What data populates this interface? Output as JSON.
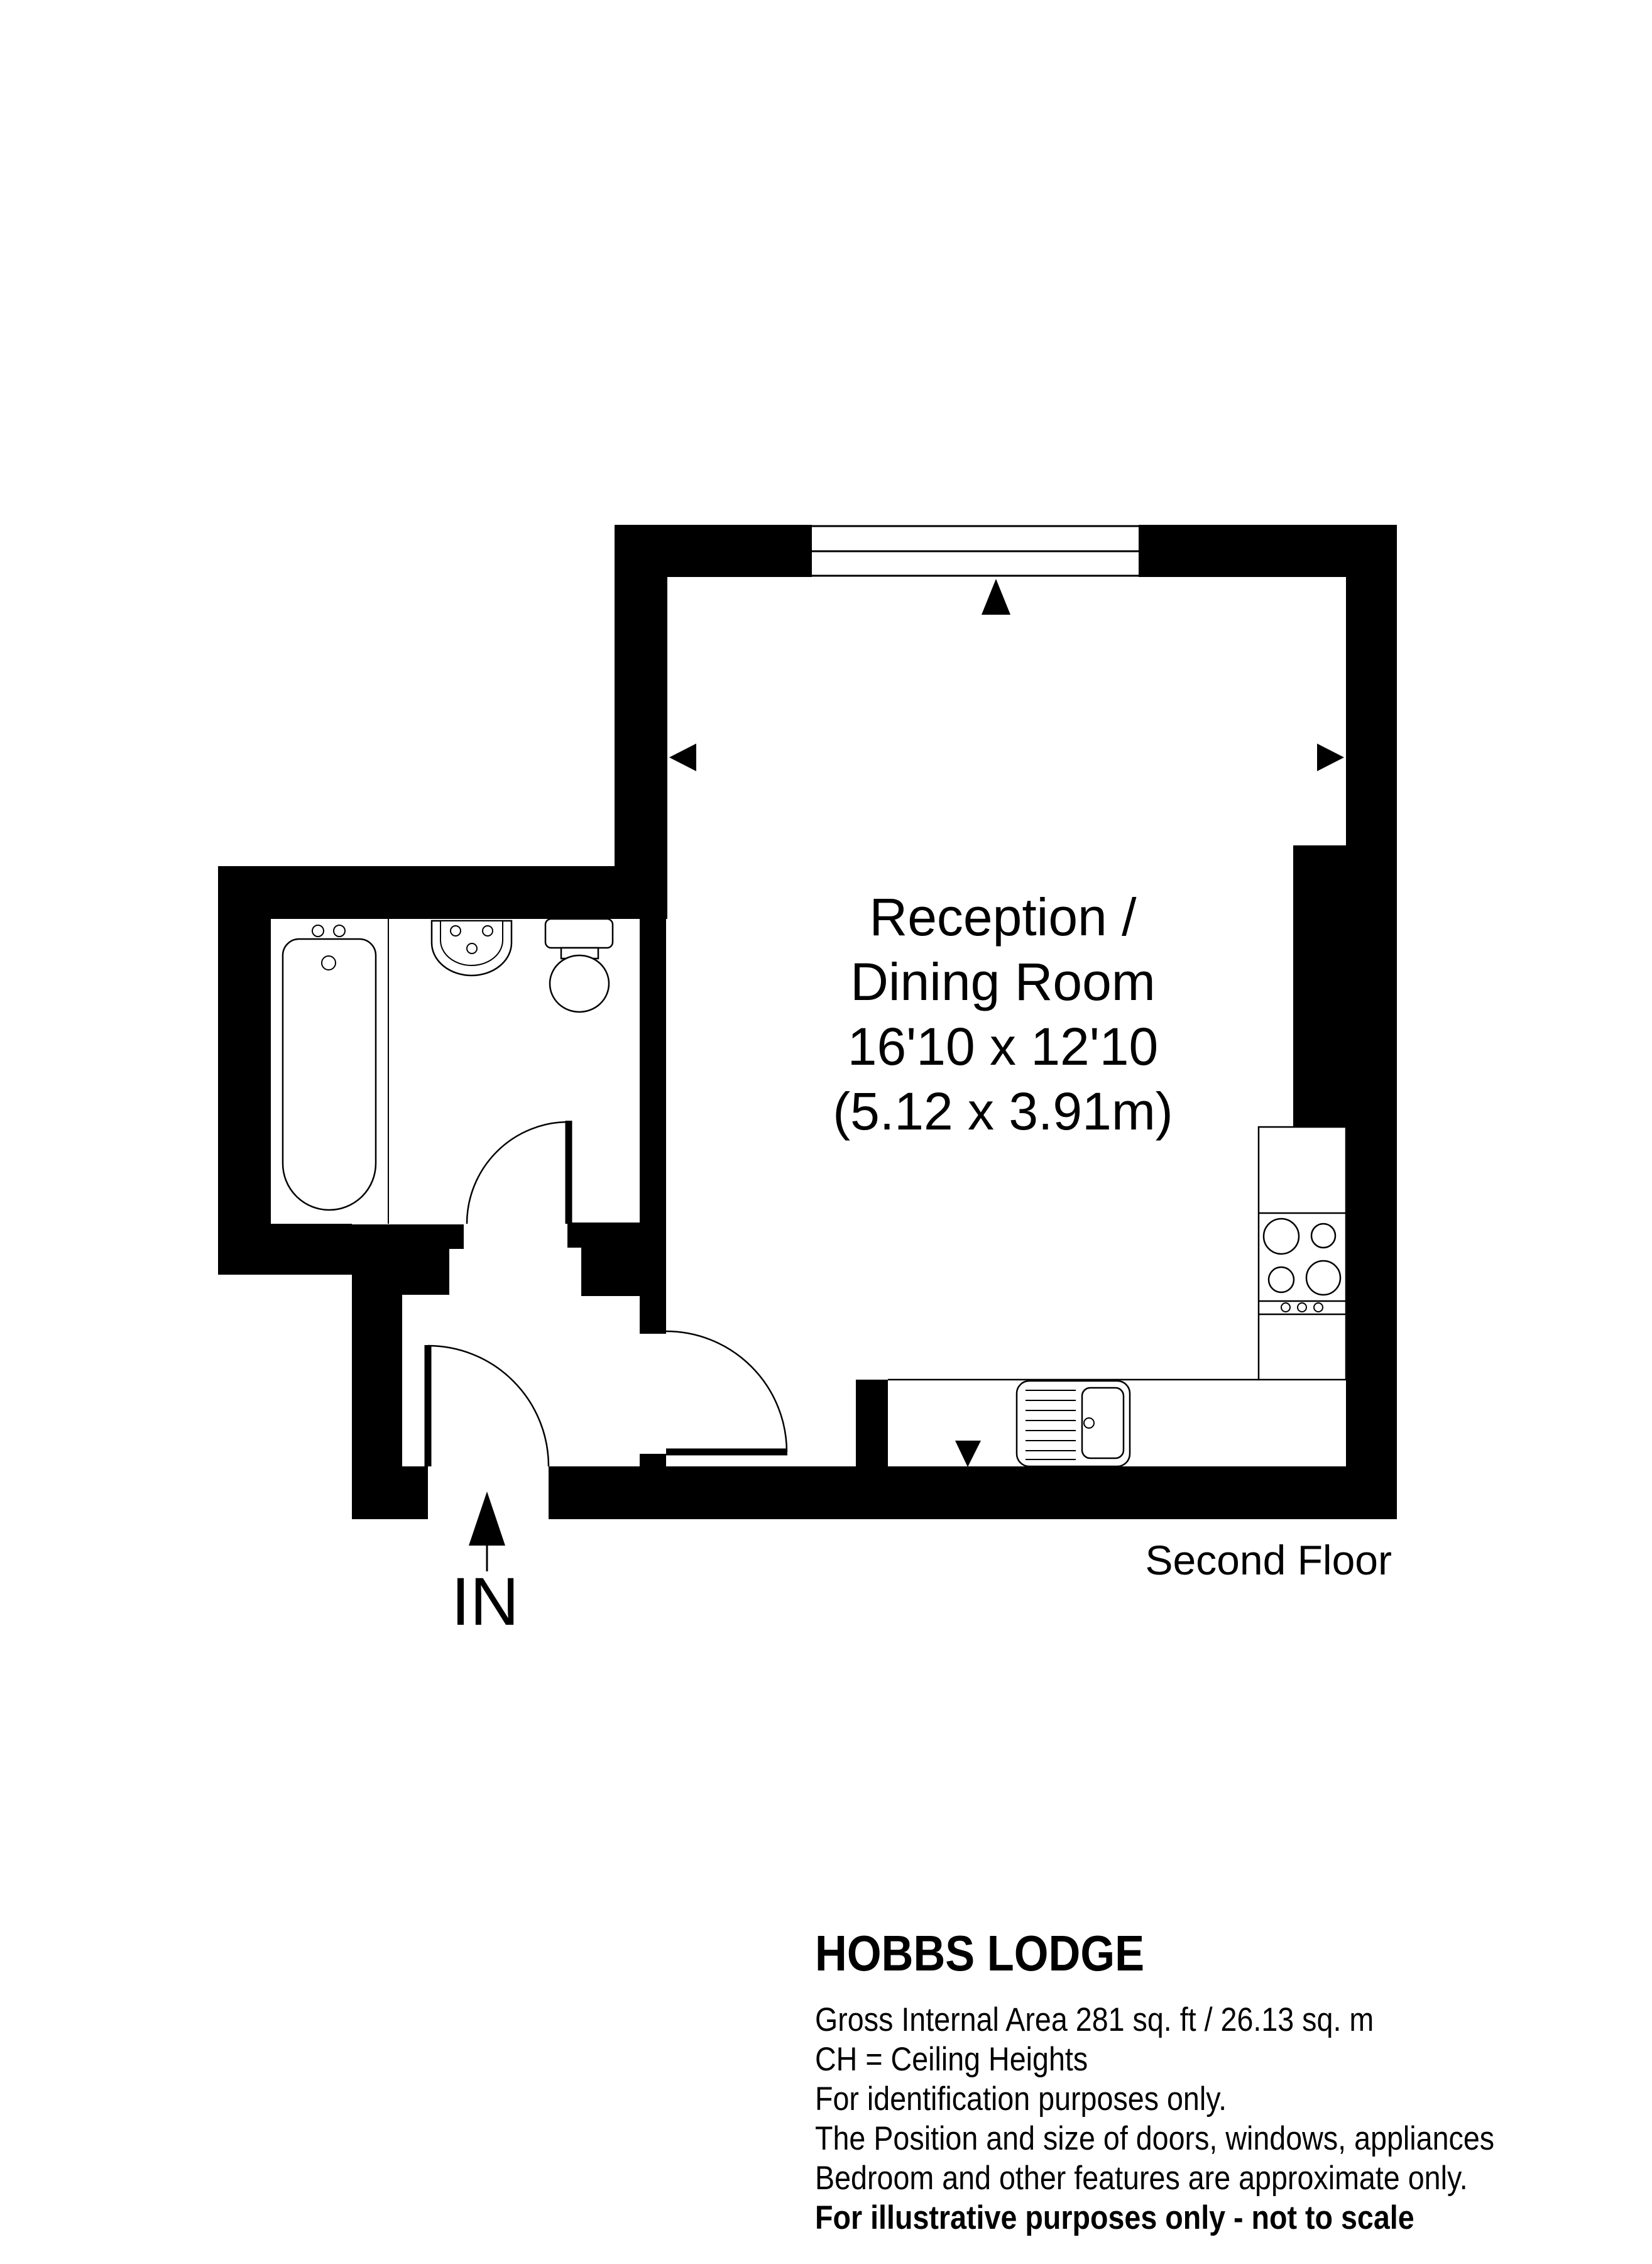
{
  "floorplan": {
    "room_label": {
      "line1": "Reception /",
      "line2": "Dining Room",
      "line3": "16'10 x 12'10",
      "line4": "(5.12 x 3.91m)"
    },
    "floor_label": "Second Floor",
    "entry_label": "IN"
  },
  "footer": {
    "title": "HOBBS LODGE",
    "lines": [
      "Gross Internal Area 281 sq. ft / 26.13 sq. m",
      "CH = Ceiling Heights",
      "For identification purposes only.",
      "The Position and size of doors, windows, appliances",
      "Bedroom and other features are approximate only.",
      "For illustrative purposes only - not to scale"
    ]
  },
  "colors": {
    "wall": "#000000",
    "background": "#ffffff",
    "line": "#000000"
  }
}
